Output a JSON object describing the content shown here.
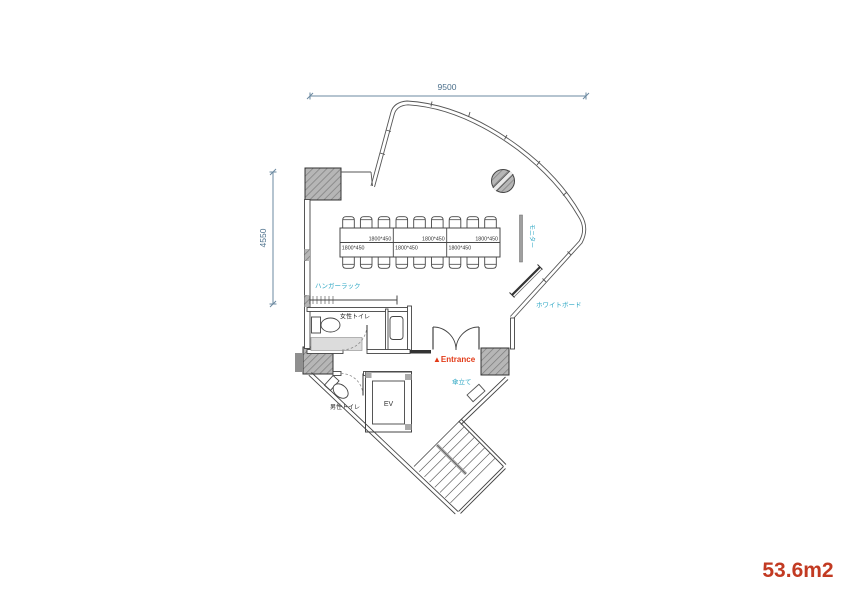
{
  "plan": {
    "area_total": "53.6m2",
    "dim_width": "9500",
    "dim_height": "4550",
    "table_labels": [
      "1800*450",
      "1800*450",
      "1800*450",
      "1800*450",
      "1800*450",
      "1800*450"
    ],
    "labels": {
      "hanger_rack": "ハンガーラック",
      "womens_toilet": "女性トイレ",
      "mens_toilet": "男性トイレ",
      "elevator": "EV",
      "monitor": "モニター",
      "whiteboard": "ホワイトボード",
      "entrance": "▲Entrance",
      "umbrella_stand": "傘立て"
    },
    "colors": {
      "feature_label": "#2ea7c4",
      "entrance": "#e23a17",
      "area": "#c23a22",
      "dimension": "#4a6e8a"
    }
  }
}
